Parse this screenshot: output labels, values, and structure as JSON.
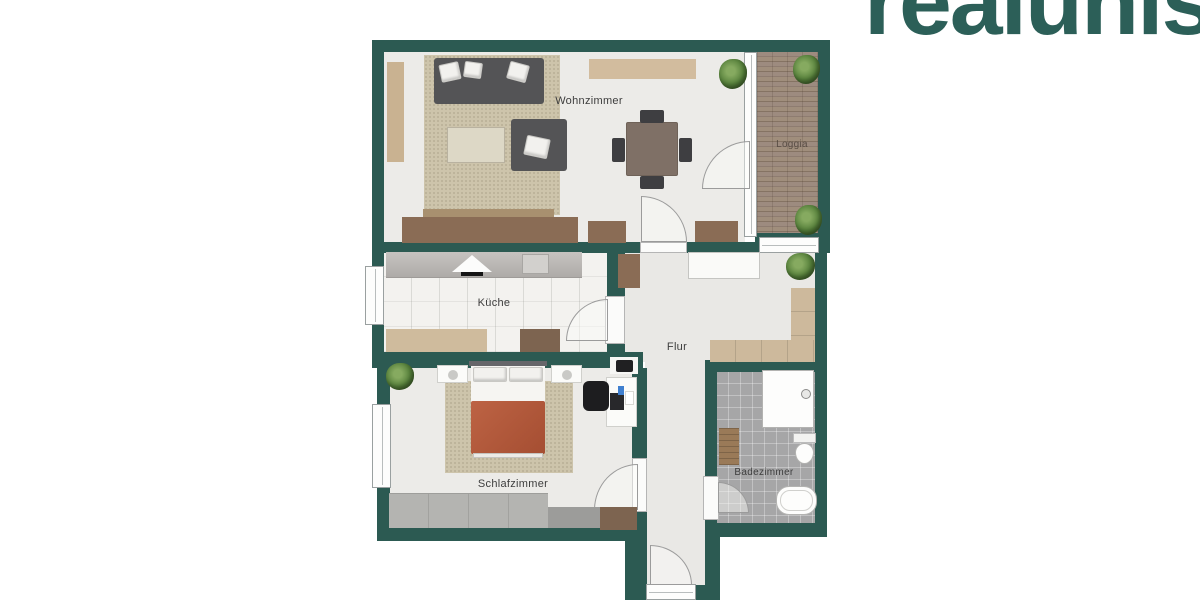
{
  "brand": {
    "logo_text": "realunis",
    "logo_color": "#2c5f58"
  },
  "floorplan": {
    "rooms": [
      {
        "id": "wohnzimmer",
        "label": "Wohnzimmer"
      },
      {
        "id": "kueche",
        "label": "Küche"
      },
      {
        "id": "flur",
        "label": "Flur"
      },
      {
        "id": "schlafzimmer",
        "label": "Schlafzimmer"
      },
      {
        "id": "badezimmer",
        "label": "Badezimmer"
      },
      {
        "id": "loggia",
        "label": "Loggia"
      }
    ],
    "furniture": [
      "sofa",
      "armchair",
      "living-rug",
      "coffee-rug",
      "dining-table",
      "dining-chairs",
      "sideboards",
      "wall-shelf",
      "plants",
      "kitchen-counter",
      "stove-hood",
      "sink",
      "kitchen-bench",
      "kitchen-table",
      "hall-sideboard",
      "hall-wardrobe",
      "double-bed",
      "nightstands",
      "bedroom-rug",
      "desk",
      "office-chair",
      "wardrobe",
      "dresser",
      "shower",
      "toilet",
      "bathtub",
      "bath-bench"
    ],
    "colors": {
      "wall": "#2c5a52",
      "floor": "#ecebe8",
      "floor-flur": "#e9e8e5",
      "kitchen-tile": "#f3f2ef",
      "bath-tile": "#a6a6a7",
      "deck": "#97857a",
      "rug": "#cdc4ab",
      "rug-light": "#ddd8c6",
      "sofa": "#545456",
      "wood-dark": "#8a6c55",
      "wood-mid": "#7d6450",
      "tan": "#cfbb9d",
      "tan-light": "#d2bc9e",
      "duvet": "#b2573b",
      "wardrobe-gray": "#b4b4b1",
      "table": "#7f7066"
    }
  }
}
